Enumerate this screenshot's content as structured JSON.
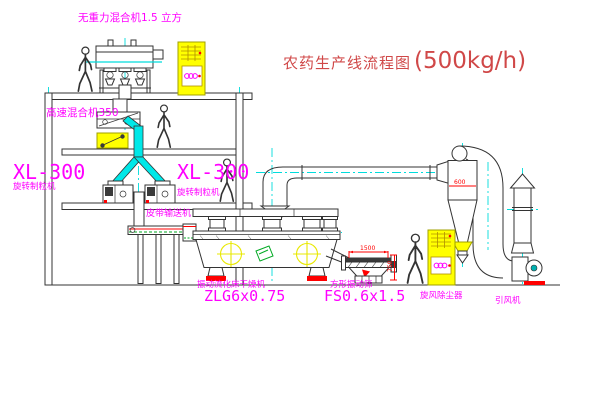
{
  "title": {
    "text": "农药生产线流程图",
    "capacity": "(500kg/h)"
  },
  "equipment": {
    "gravity_free_mixer": {
      "label": "无重力混合机1.5 立方"
    },
    "high_speed_mixer": {
      "label": "高速混合机350"
    },
    "granulator_left": {
      "model": "XL-300",
      "name": "旋转制粒机"
    },
    "granulator_mid": {
      "model": "XL-300",
      "name": "旋转制粒机"
    },
    "belt_conveyor": {
      "label": "皮带输送机"
    },
    "fluid_bed_dryer": {
      "name": "振动流化床干燥机",
      "model": "ZLG6x0.75"
    },
    "vibrating_sieve": {
      "name": "方形振动筛",
      "model": "FS0.6x1.5"
    },
    "cyclone_dust_collector": {
      "label": "旋风除尘器"
    },
    "induced_draft_fan": {
      "label": "引风机"
    }
  },
  "dimensions": {
    "sieve_length": "1500",
    "sieve_height": "750",
    "cyclone_diameter": "600"
  },
  "colors": {
    "label_magenta": "#ff00ff",
    "title_red": "#d04848",
    "dimension_red": "#ff0000",
    "machine_yellow": "#ffff00",
    "centerline_cyan": "#00dcdc",
    "line_dark": "#333333",
    "accent_green": "#00aa22"
  }
}
